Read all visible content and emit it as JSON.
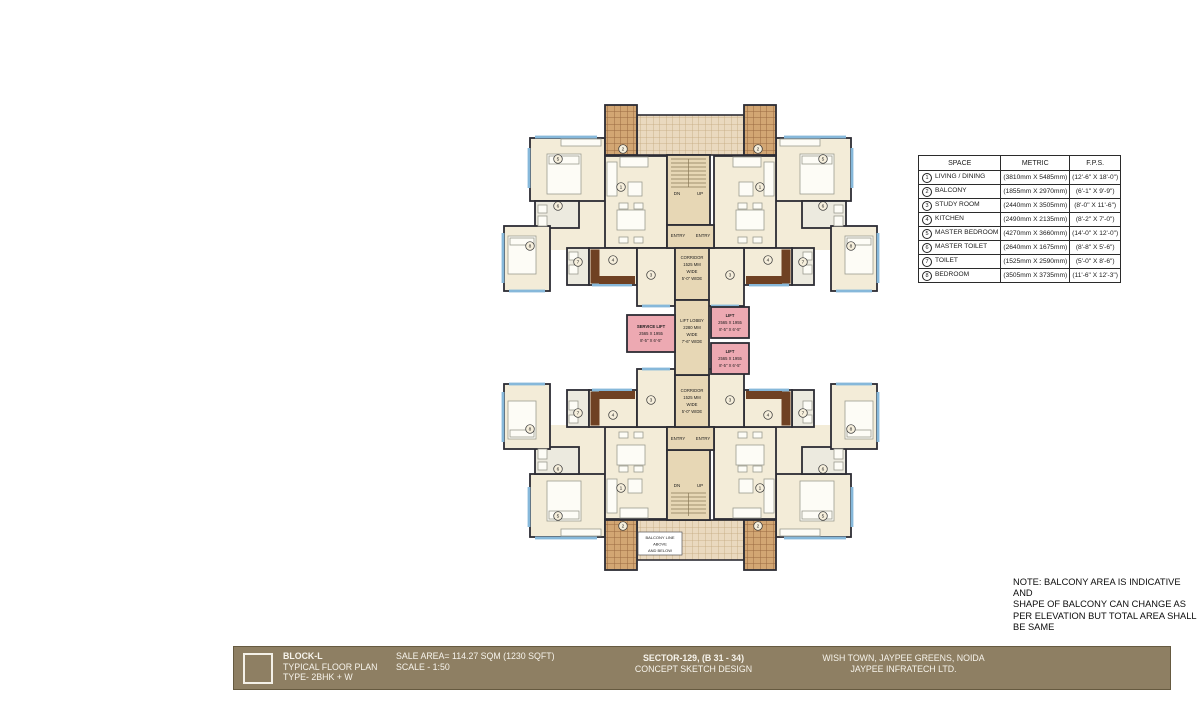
{
  "legend": {
    "headers": [
      "SPACE",
      "METRIC",
      "F.P.S."
    ],
    "rows": [
      {
        "id": "1",
        "space": "LIVING / DINING",
        "metric": "(3810mm X 5485mm)",
        "fps": "(12'-6\" X 18'-0\")"
      },
      {
        "id": "2",
        "space": "BALCONY",
        "metric": "(1855mm X 2970mm)",
        "fps": "(6'-1\" X 9'-9\")"
      },
      {
        "id": "3",
        "space": "STUDY ROOM",
        "metric": "(2440mm X 3505mm)",
        "fps": "(8'-0\" X 11'-6\")"
      },
      {
        "id": "4",
        "space": "KITCHEN",
        "metric": "(2490mm X 2135mm)",
        "fps": "(8'-2\" X 7'-0\")"
      },
      {
        "id": "5",
        "space": "MASTER BEDROOM",
        "metric": "(4270mm X 3660mm)",
        "fps": "(14'-0\" X 12'-0\")"
      },
      {
        "id": "6",
        "space": "MASTER TOILET",
        "metric": "(2640mm X 1675mm)",
        "fps": "(8'-8\" X 5'-6\")"
      },
      {
        "id": "7",
        "space": "TOILET",
        "metric": "(1525mm X 2590mm)",
        "fps": "(5'-0\" X 8'-6\")"
      },
      {
        "id": "8",
        "space": "BEDROOM",
        "metric": "(3505mm X 3735mm)",
        "fps": "(11'-6\" X 12'-3\")"
      }
    ]
  },
  "note": {
    "lines": [
      "NOTE: BALCONY AREA IS INDICATIVE AND",
      "SHAPE OF BALCONY CAN CHANGE AS",
      "PER ELEVATION BUT TOTAL AREA SHALL",
      "BE SAME"
    ]
  },
  "title_bar": {
    "block": "BLOCK-L",
    "plan_type": "TYPICAL FLOOR PLAN",
    "unit_type": "TYPE- 2BHK + W",
    "sale_area": "SALE AREA= 114.27 SQM (1230 SQFT)",
    "scale": "SCALE - 1:50",
    "sector": "SECTOR-129, (B 31 - 34)",
    "design": "CONCEPT SKETCH DESIGN",
    "location": "WISH TOWN, JAYPEE GREENS, NOIDA",
    "company": "JAYPEE INFRATECH LTD."
  },
  "plan": {
    "room_numbers": [
      "1",
      "2",
      "3",
      "4",
      "5",
      "6",
      "7",
      "8"
    ],
    "service_lift": [
      "SERVICE LIFT",
      "2565 X 1955",
      "8'-5\" X 6'-5\""
    ],
    "lift": [
      "LIFT",
      "2565 X 1955",
      "8'-5\" X 6'-5\""
    ],
    "lift_lobby": [
      "LIFT LOBBY",
      "2280 MM",
      "WIDE",
      "7'-6\" WIDE"
    ],
    "corridor": [
      "CORRIDOR",
      "1525 MM",
      "WIDE",
      "5'-0\" WIDE"
    ],
    "entry": "ENTRY",
    "dn": "DN",
    "up": "UP",
    "balcony_line": [
      "BALCONY LINE",
      "ABOVE",
      "AND BELOW"
    ]
  },
  "colors": {
    "wall": "#2c2c34",
    "room": "#f3ecd8",
    "wet": "#eceadf",
    "service": "#e7d7b5",
    "lift_pink": "#eda9b2",
    "balcony_tile": "#d2a673",
    "balcony_grout": "#9a6a42",
    "terrace_tile": "#ead9bf",
    "terrace_grout": "#c3a87e",
    "window_blue": "#86b8da",
    "counter": "#6f4123",
    "bar_bg": "#8e7f63"
  }
}
